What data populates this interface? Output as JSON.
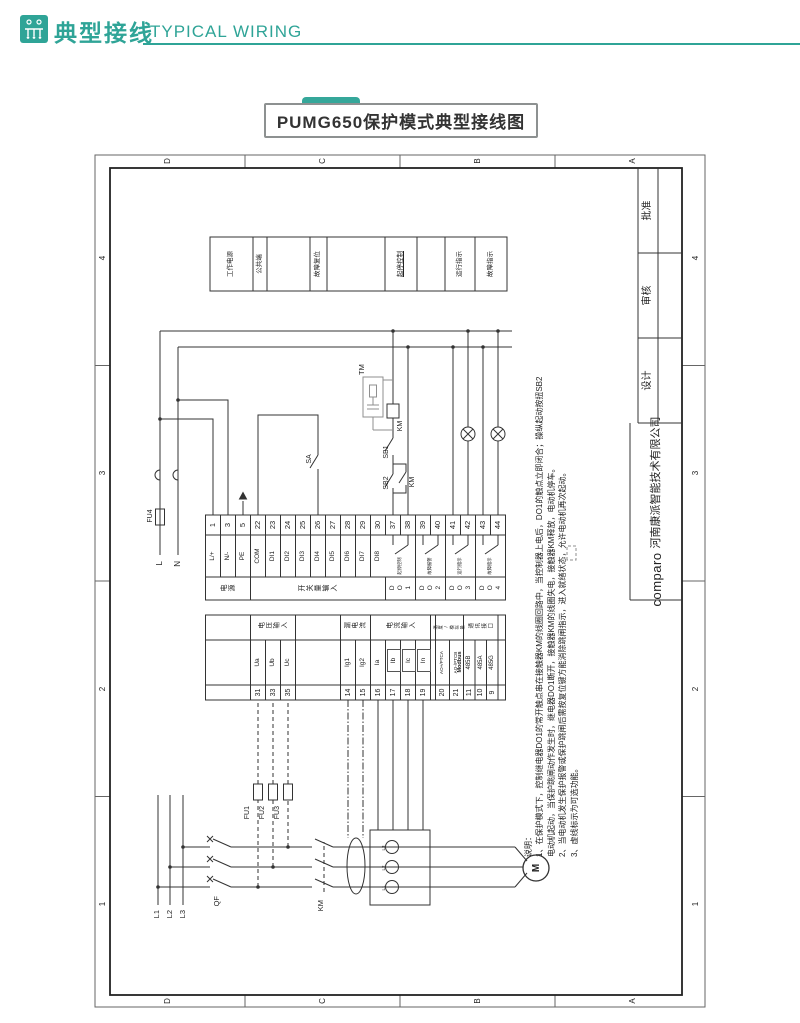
{
  "header": {
    "brand_cn": "典型接线",
    "brand_en": "TYPICAL WIRING"
  },
  "badge": {
    "title": "PUMG650保护模式典型接线图"
  },
  "colors": {
    "teal": "#2fa497",
    "line": "#333333",
    "optional_grey": "#8f8f8f"
  },
  "zones": {
    "numbers": [
      "1",
      "2",
      "3",
      "4"
    ],
    "letters": [
      "D",
      "C",
      "B",
      "A"
    ]
  },
  "title_block": {
    "design": "设计",
    "review": "审核",
    "approve": "批准",
    "logo": "comparo",
    "company": "河南康派智能技术有限公司"
  },
  "legend": {
    "cells": [
      "工作电源",
      "公共端",
      "",
      "故障复位",
      "",
      "起停控制",
      "",
      "运行指示",
      "故障指示"
    ]
  },
  "device": {
    "right_strip": {
      "groups": [
        "电源",
        "开关量输入",
        "DO1",
        "DO2",
        "DO3",
        "DO4"
      ],
      "terminals": [
        {
          "no": "1",
          "name": "L/+"
        },
        {
          "no": "3",
          "name": "N/-"
        },
        {
          "no": "5",
          "name": "PE"
        },
        {
          "no": "22",
          "name": "COM"
        },
        {
          "no": "23",
          "name": "DI1"
        },
        {
          "no": "24",
          "name": "DI2"
        },
        {
          "no": "25",
          "name": "DI3"
        },
        {
          "no": "26",
          "name": "DI4"
        },
        {
          "no": "27",
          "name": "DI5"
        },
        {
          "no": "28",
          "name": "DI6"
        },
        {
          "no": "29",
          "name": "DI7"
        },
        {
          "no": "30",
          "name": "DI8"
        },
        {
          "no": "37",
          "name": ""
        },
        {
          "no": "38",
          "name": ""
        },
        {
          "no": "39",
          "name": ""
        },
        {
          "no": "40",
          "name": ""
        },
        {
          "no": "41",
          "name": ""
        },
        {
          "no": "42",
          "name": ""
        },
        {
          "no": "43",
          "name": ""
        },
        {
          "no": "44",
          "name": ""
        }
      ],
      "do_contact_labels": [
        "起停控制",
        "故障报警",
        "运行指示",
        "故障指示"
      ]
    },
    "left_strip": {
      "groups": [
        "电压输入",
        "漏电流",
        "电流输入",
        "温度/模拟量",
        "通讯接口"
      ],
      "modbus": "Modbus",
      "terminals": [
        {
          "no": "31",
          "name": "Ua"
        },
        {
          "no": "33",
          "name": "Ub"
        },
        {
          "no": "35",
          "name": "Uc"
        },
        {
          "no": "14",
          "name": "Ig1"
        },
        {
          "no": "15",
          "name": "Ig2"
        },
        {
          "no": "16",
          "name": "Ia"
        },
        {
          "no": "17",
          "name": "Ib"
        },
        {
          "no": "18",
          "name": "Ic"
        },
        {
          "no": "19",
          "name": "In"
        },
        {
          "no": "20",
          "name": "AO+/PTCA"
        },
        {
          "no": "21",
          "name": "AO-/PTCB"
        },
        {
          "no": "11",
          "name": "485B"
        },
        {
          "no": "10",
          "name": "485A"
        },
        {
          "no": "9",
          "name": "485G"
        }
      ]
    }
  },
  "wiring": {
    "l": "L",
    "n": "N",
    "fu4": "FU4",
    "tm": "TM",
    "km_coil": "KM",
    "sb1": "SB1",
    "sb2": "SB2",
    "km_aux": "KM",
    "sa": "SA",
    "qf": "QF",
    "km_main": "KM",
    "fu1": "FU1",
    "fu2": "FU2",
    "fu3": "FU3",
    "l1": "L1",
    "l2": "L2",
    "l3": "L3",
    "motor": "M",
    "ct_labels": [
      "L1",
      "L2",
      "L3"
    ]
  },
  "notes": {
    "lines": [
      "说明：",
      "1、在保护模式下，控制继电器DO1的常开触点串在接触器KM的线圈回路中，当控制器上电后，DO1的触点立即闭合；操纵起动按扭SB2",
      "电动机起动，当保护跳闸动作发生时，继电器DO1断开，接触器KM的线圈失电，接触器KM释放，电动机停车。",
      "2、当电动机发生保护报警或保护跳闸后需按复位键方能消除跳闸指示，进入就绪状态，允许电动机再次起动。",
      "3、虚线标示为可选功能。"
    ]
  }
}
